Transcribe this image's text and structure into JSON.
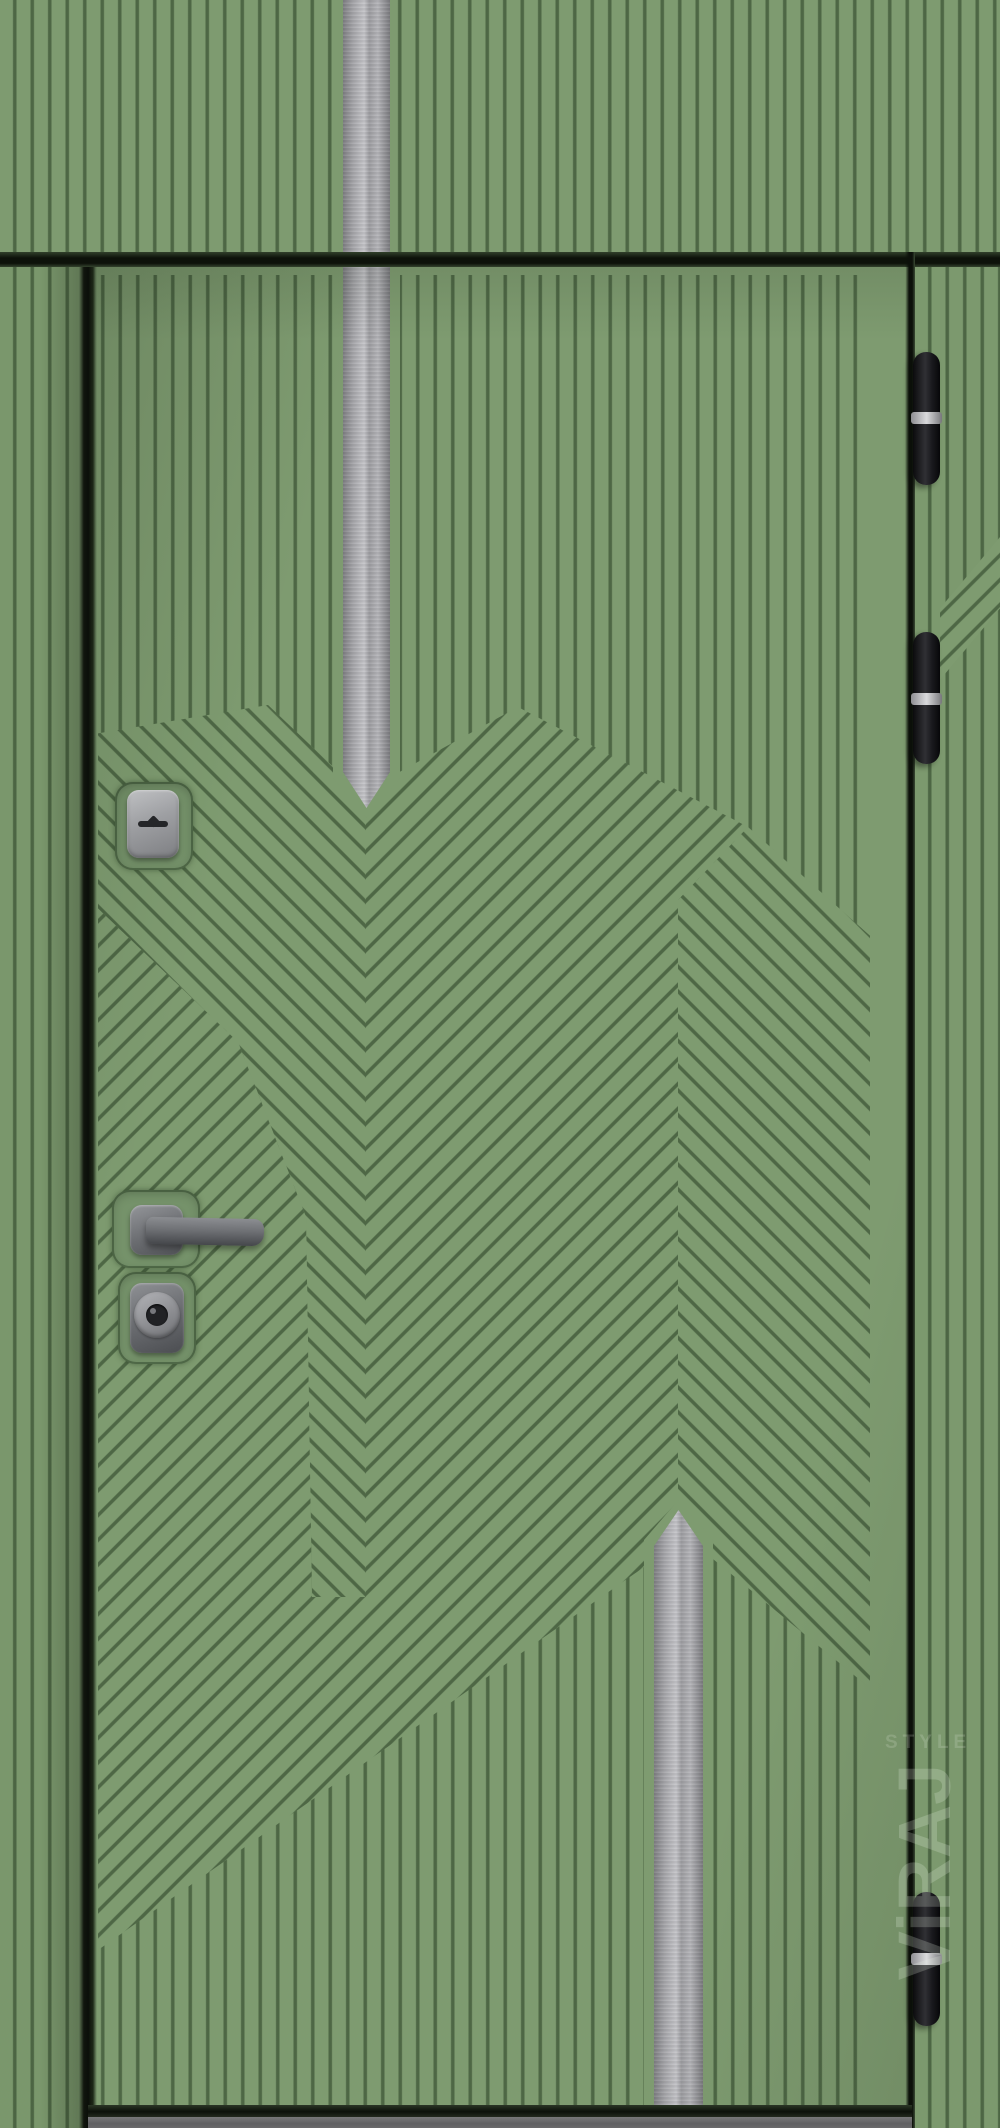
{
  "meta": {
    "type": "product-photo",
    "subject": "Entrance steel door, green vertical-ribbed finish with chevron milling, transom panel above"
  },
  "watermark": {
    "brand": "ViRAJ",
    "subtext": "STYLE"
  },
  "door": {
    "panels": {
      "transom": "striped panel with central stainless insert",
      "leaf": "milled stripe/chevron pattern with two pointed stainless inserts"
    },
    "hardware": {
      "hinges_count": 3,
      "deadbolt_escutcheon": "rounded square with horizontal key slot",
      "handle": "lever handle on square rose",
      "cylinder": "round cylinder escutcheon on square plate"
    },
    "colors": {
      "face_green": "#7e9b70",
      "groove_green": "#5b7a52",
      "recess_green": "#75926a",
      "steel_insert": "#b8b8bc",
      "hinge_black": "#17171a",
      "hardware_gray": "#85878b",
      "threshold_gray": "#646466",
      "frame_shadow": "#0d120a",
      "watermark": "#e9f1e5"
    }
  }
}
